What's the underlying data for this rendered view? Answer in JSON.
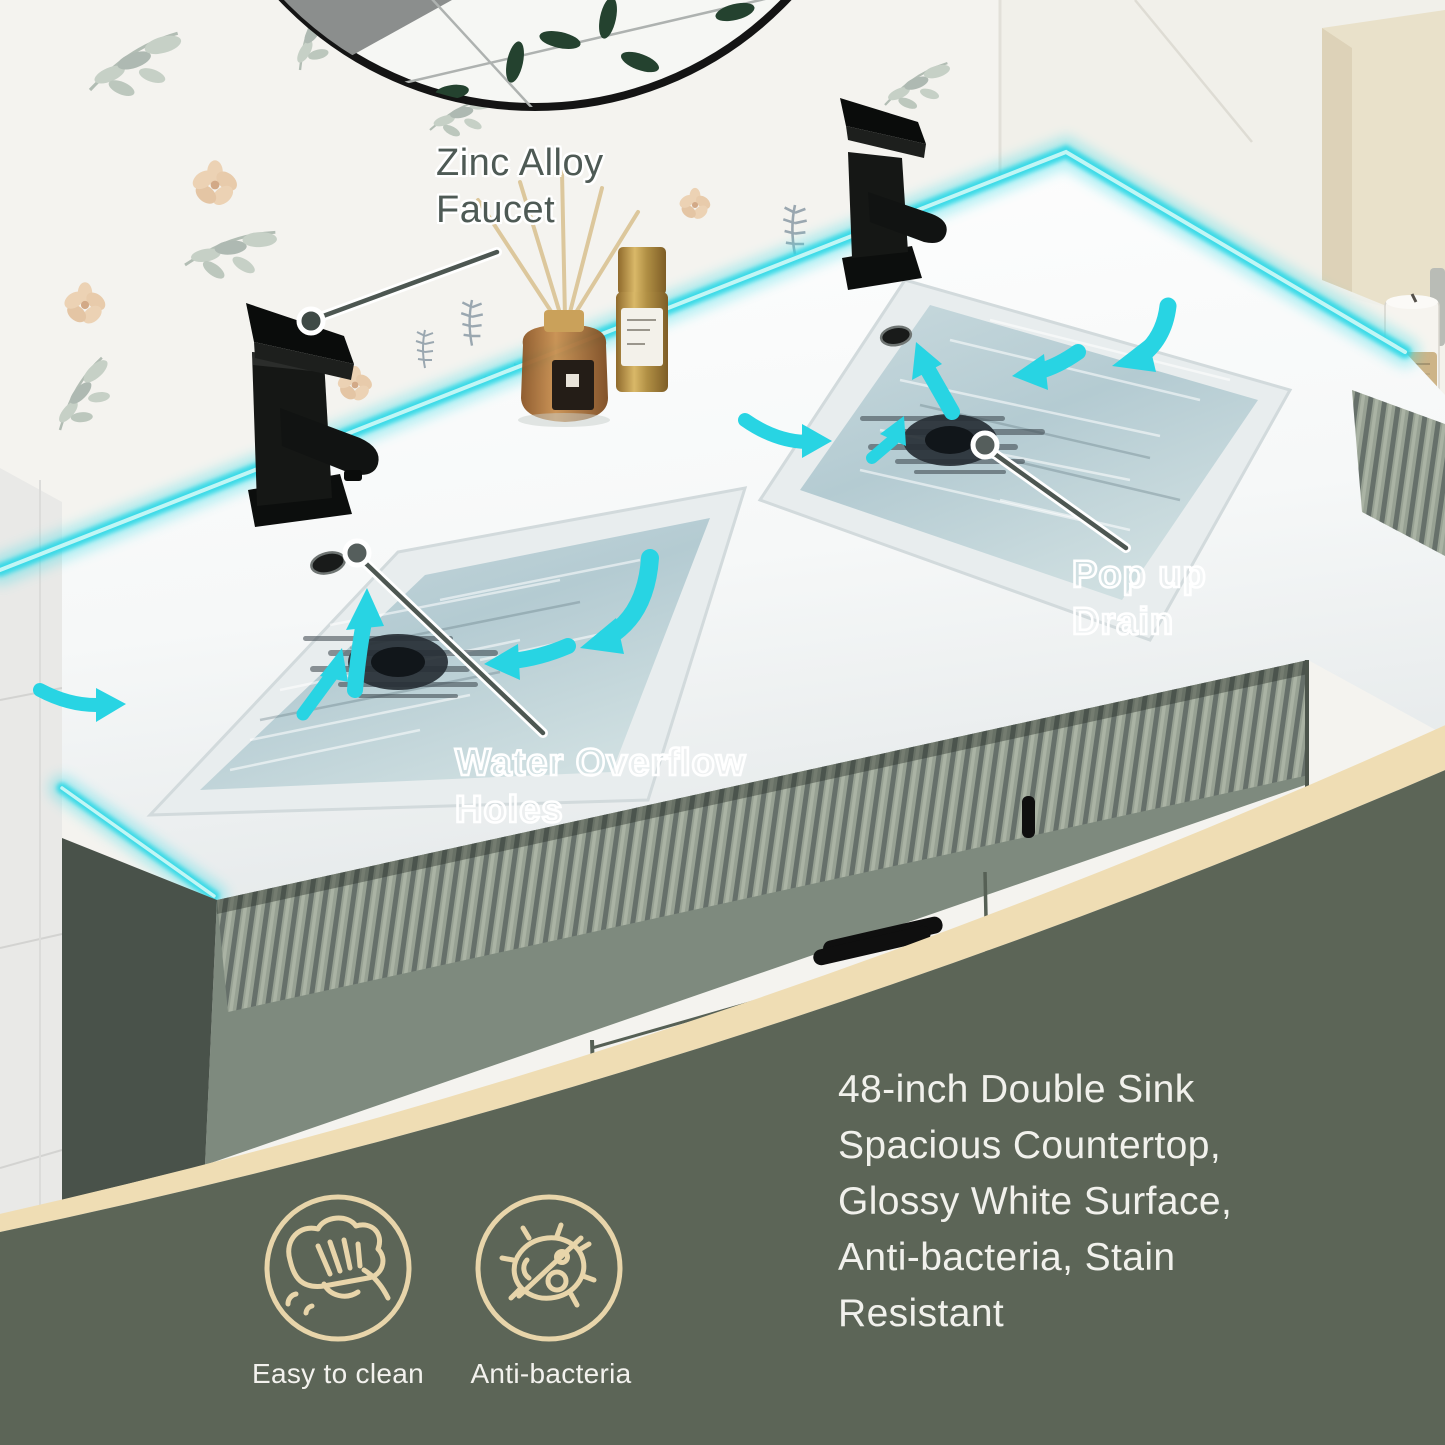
{
  "annotations": {
    "faucet": {
      "line1": "Zinc Alloy",
      "line2": "Faucet"
    },
    "popup_drain": {
      "line1": "Pop up",
      "line2": "Drain"
    },
    "overflow": {
      "line1": "Water Overflow",
      "line2": "Holes"
    }
  },
  "features": {
    "lines": [
      "48-inch Double Sink",
      "Spacious Countertop,",
      "Glossy White Surface,",
      "Anti-bacteria, Stain",
      "Resistant"
    ]
  },
  "badges": [
    {
      "label": "Easy to clean",
      "icon": "wipe-hand-icon"
    },
    {
      "label": "Anti-bacteria",
      "icon": "no-bacteria-icon"
    }
  ],
  "colors": {
    "accent_cyan": "#33d9e6",
    "band_beige": "#efddb4",
    "overlay_green": "#5c6557",
    "icon_beige": "#e8d5aa",
    "cabinet_green": "#8f998c",
    "annotation_dark": "#4e5a55",
    "water_blue": "#b7cdd4"
  }
}
